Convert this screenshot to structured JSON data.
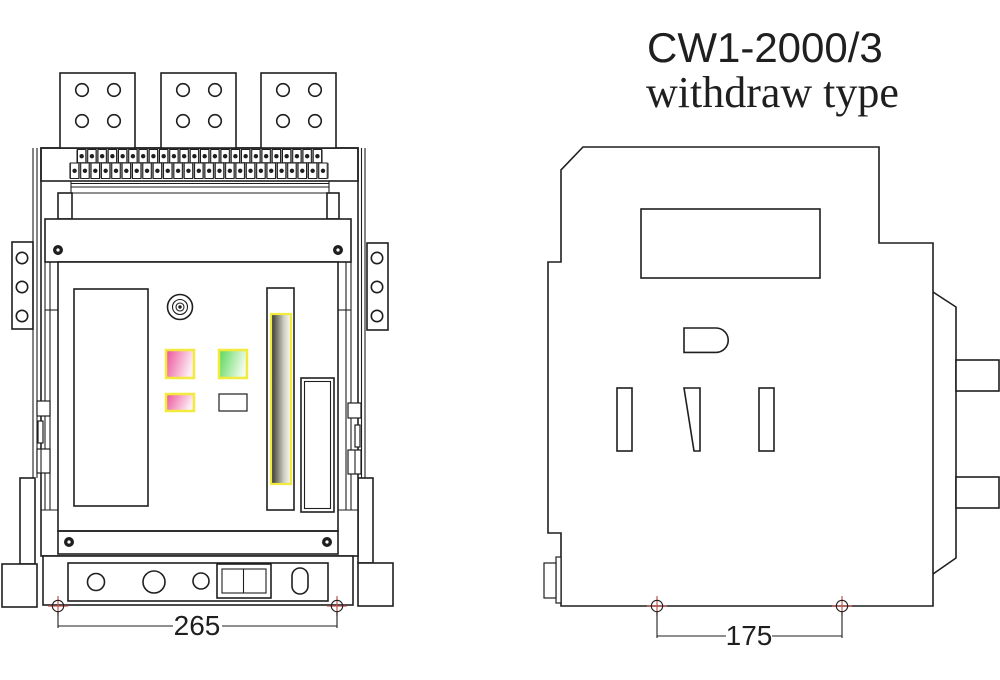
{
  "title": {
    "line1": "CW1-2000/3",
    "line2": "withdraw type"
  },
  "front_view": {
    "dimension_label": "265",
    "busbar_pads": 3,
    "holes_per_pad": 4,
    "terminal_row_top_count": 24,
    "terminal_row_bottom_count": 25,
    "bracket_holes_per_side": 3
  },
  "side_view": {
    "dimension_label": "175"
  },
  "colors": {
    "ink": "#1f1f1f",
    "button_pink_start": "#ec4f97",
    "button_pink_end": "#fdeef6",
    "button_green_start": "#57d757",
    "button_green_end": "#f0fbec",
    "highlight_yellow": "#f2ea3d",
    "strip_dark": "#32322c",
    "strip_mid": "#cfcfc2",
    "strip_light": "#fbfbf5",
    "datum_red": "#c25653",
    "terminal_gray": "#8c8c8c"
  }
}
